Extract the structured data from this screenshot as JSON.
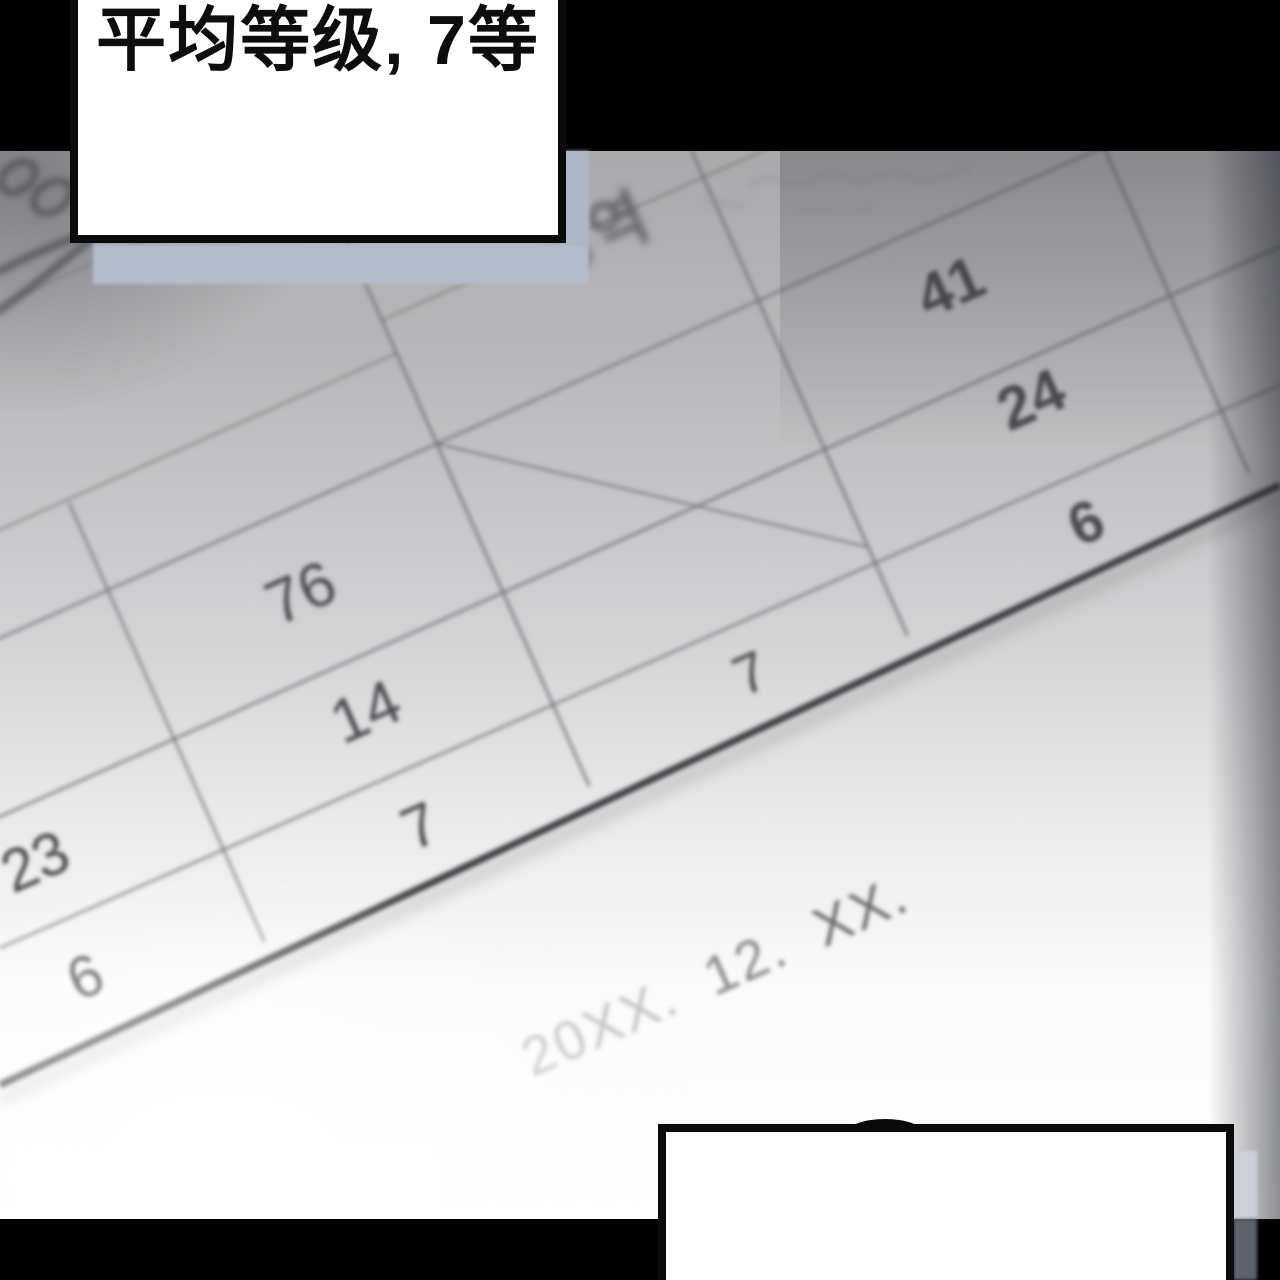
{
  "bubble_top": {
    "text": "平均等级, 7等"
  },
  "bubble_bottom": {
    "text": ""
  },
  "photo": {
    "table": {
      "header_label": "역",
      "corner_mark": "XX",
      "right_column": [
        "41",
        "24",
        "6"
      ],
      "middle_column": [
        "76",
        "14",
        "7"
      ],
      "left_column": [
        "23",
        "6"
      ],
      "center_cell": "7"
    },
    "date": {
      "year": "20XX.",
      "month": "12.",
      "day": "XX."
    }
  },
  "colors": {
    "letterbox": "#000000",
    "bubble_fill": "#ffffff",
    "bubble_border": "#0a0a0a",
    "shadow_band": "#b4bdcb",
    "shadow_strip_light": "#ccd1d9",
    "shadow_strip_dark": "#5d626c",
    "table_line": "#6b6c72",
    "table_thick_line": "#3f3f44",
    "number_ink": "#4b4c50"
  }
}
